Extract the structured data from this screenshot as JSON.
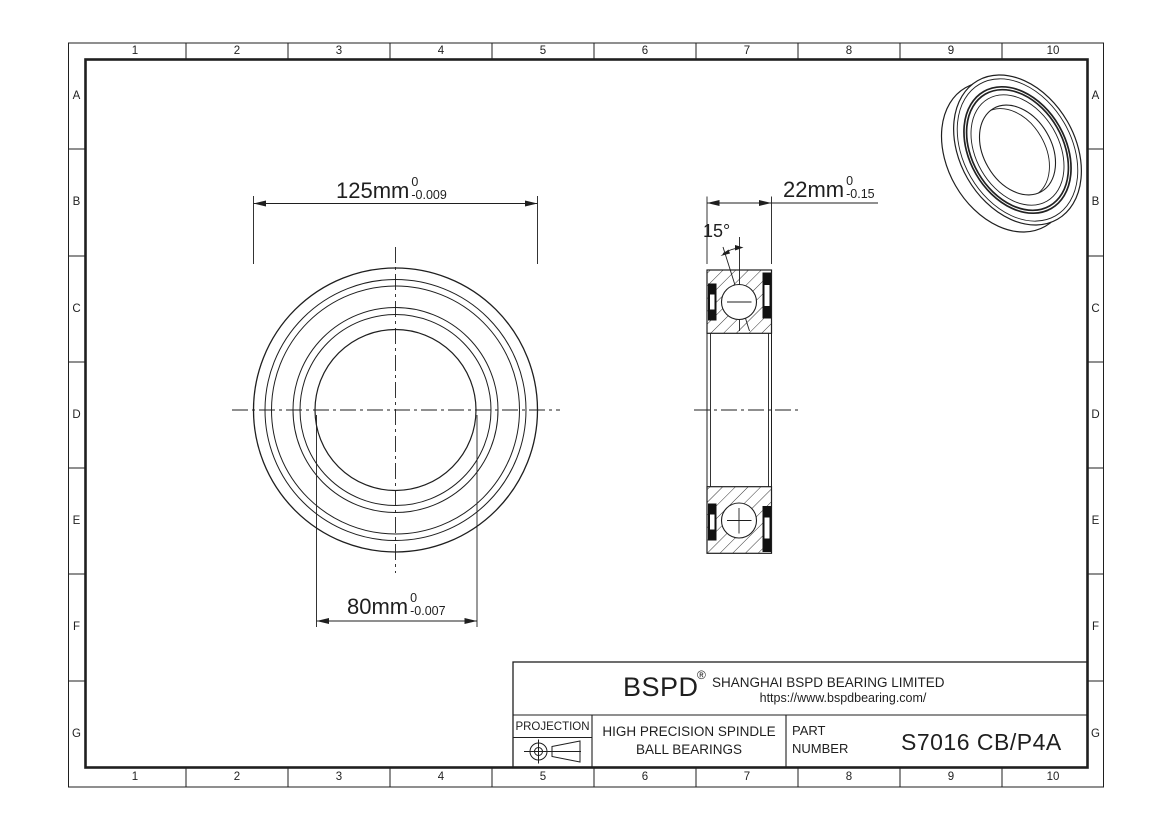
{
  "drawing": {
    "grid": {
      "columns": [
        "1",
        "2",
        "3",
        "4",
        "5",
        "6",
        "7",
        "8",
        "9",
        "10"
      ],
      "rows": [
        "A",
        "B",
        "C",
        "D",
        "E",
        "F",
        "G"
      ]
    },
    "dimensions": {
      "outer_diameter": {
        "value": "125mm",
        "tol_upper": "0",
        "tol_lower": "-0.009"
      },
      "bore_diameter": {
        "value": "80mm",
        "tol_upper": "0",
        "tol_lower": "-0.007"
      },
      "width": {
        "value": "22mm",
        "tol_upper": "0",
        "tol_lower": "-0.15"
      },
      "contact_angle": "15°"
    },
    "title_block": {
      "logo": "BSPD",
      "registered_mark": "®",
      "company": "SHANGHAI BSPD BEARING LIMITED",
      "website": "https://www.bspdbearing.com/",
      "projection_label": "PROJECTION",
      "product_line1": "HIGH  PRECISION SPINDLE",
      "product_line2": "BALL BEARINGS",
      "part_label_line1": "PART",
      "part_label_line2": "NUMBER",
      "part_number": "S7016 CB/P4A"
    },
    "colors": {
      "line": "#1f1f1f",
      "background": "#ffffff",
      "seal": "#111111"
    }
  }
}
